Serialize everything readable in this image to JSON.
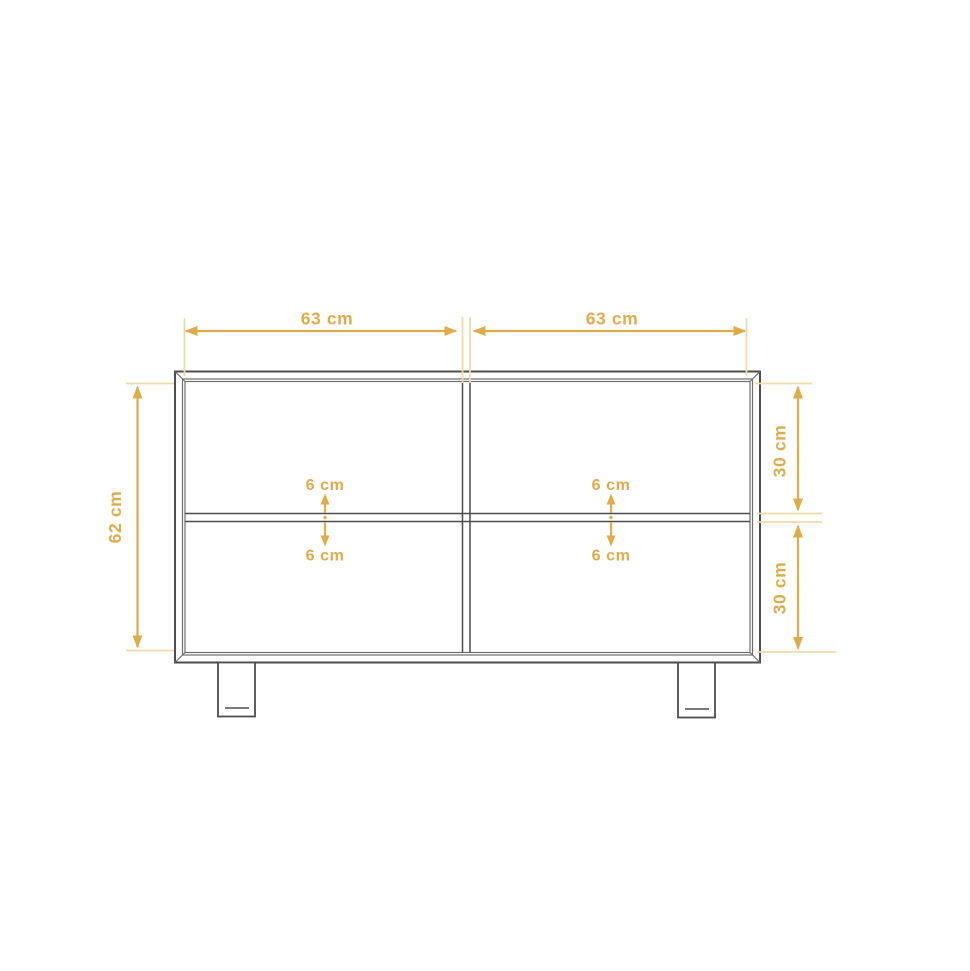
{
  "colors": {
    "background": "#ffffff",
    "dimension": "#dfac4c",
    "extension": "#ecdcaa",
    "outline_dark": "#4d4d4d",
    "outline_light": "#6f6f6f"
  },
  "unit": "cm",
  "labels": {
    "width_left": "63 cm",
    "width_right": "63 cm",
    "height_total": "62 cm",
    "section_top_height": "30 cm",
    "section_bottom_height": "30 cm",
    "shelf_gap_top_left": "6 cm",
    "shelf_gap_bottom_left": "6 cm",
    "shelf_gap_top_right": "6 cm",
    "shelf_gap_bottom_right": "6 cm"
  },
  "measurements": {
    "compartment_width_left_cm": 63,
    "compartment_width_right_cm": 63,
    "total_height_cm": 62,
    "top_section_height_cm": 30,
    "bottom_section_height_cm": 30,
    "shelf_gap_cm": 6
  }
}
